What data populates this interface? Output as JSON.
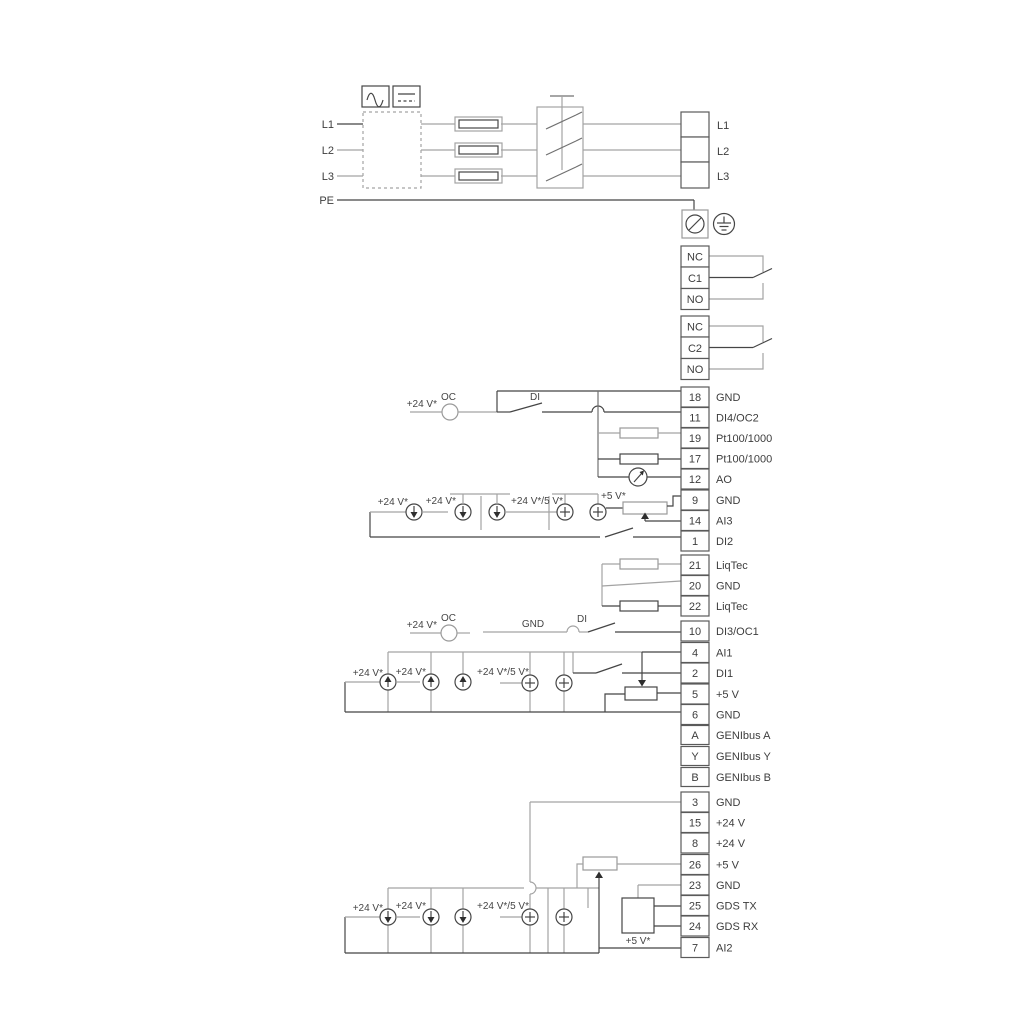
{
  "colors": {
    "line_dark": "#454545",
    "line_gray": "#a3a3a3",
    "text": "#3d3d3d",
    "background": "#ffffff"
  },
  "icons": {
    "ac": "ac-waveform-icon",
    "dc": "dc-line-icon",
    "fuse": "fuse-icon",
    "main_switch": "main-switch-icon",
    "screen_clamp": "screen-clamp-icon",
    "earth": "earth-ground-icon",
    "open_collector": "open-collector-circle-icon",
    "current_source": "current-source-circle-icon",
    "plus_source": "plus-circle-icon",
    "meter": "analog-output-meter-icon",
    "potentiometer": "potentiometer-icon"
  },
  "power": {
    "left": [
      "L1",
      "L2",
      "L3"
    ],
    "pe": "PE",
    "right": [
      "L1",
      "L2",
      "L3"
    ]
  },
  "relay1": {
    "rows": [
      "NC",
      "C1",
      "NO"
    ]
  },
  "relay2": {
    "rows": [
      "NC",
      "C2",
      "NO"
    ]
  },
  "io_a": [
    {
      "num": "18",
      "label": "GND"
    },
    {
      "num": "11",
      "label": "DI4/OC2"
    },
    {
      "num": "19",
      "label": "Pt100/1000"
    },
    {
      "num": "17",
      "label": "Pt100/1000"
    },
    {
      "num": "12",
      "label": "AO"
    },
    {
      "num": "9",
      "label": "GND"
    },
    {
      "num": "14",
      "label": "AI3"
    },
    {
      "num": "1",
      "label": "DI2"
    }
  ],
  "io_b": [
    {
      "num": "21",
      "label": "LiqTec"
    },
    {
      "num": "20",
      "label": "GND"
    },
    {
      "num": "22",
      "label": "LiqTec"
    }
  ],
  "io_c": [
    {
      "num": "10",
      "label": "DI3/OC1"
    }
  ],
  "io_d": [
    {
      "num": "4",
      "label": "AI1"
    },
    {
      "num": "2",
      "label": "DI1"
    },
    {
      "num": "5",
      "label": "+5 V"
    },
    {
      "num": "6",
      "label": "GND"
    }
  ],
  "io_e": [
    {
      "num": "A",
      "label": "GENIbus A"
    },
    {
      "num": "Y",
      "label": "GENIbus Y"
    },
    {
      "num": "B",
      "label": "GENIbus B"
    }
  ],
  "io_f": [
    {
      "num": "3",
      "label": "GND"
    },
    {
      "num": "15",
      "label": "+24 V"
    },
    {
      "num": "8",
      "label": "+24 V"
    },
    {
      "num": "26",
      "label": "+5 V"
    },
    {
      "num": "23",
      "label": "GND"
    },
    {
      "num": "25",
      "label": "GDS TX"
    },
    {
      "num": "24",
      "label": "GDS RX"
    },
    {
      "num": "7",
      "label": "AI2"
    }
  ],
  "ann": {
    "v24": "+24 V*",
    "v24_5": "+24 V*/5 V*",
    "v5": "+5 V*",
    "oc": "OC",
    "di": "DI",
    "gnd": "GND"
  }
}
